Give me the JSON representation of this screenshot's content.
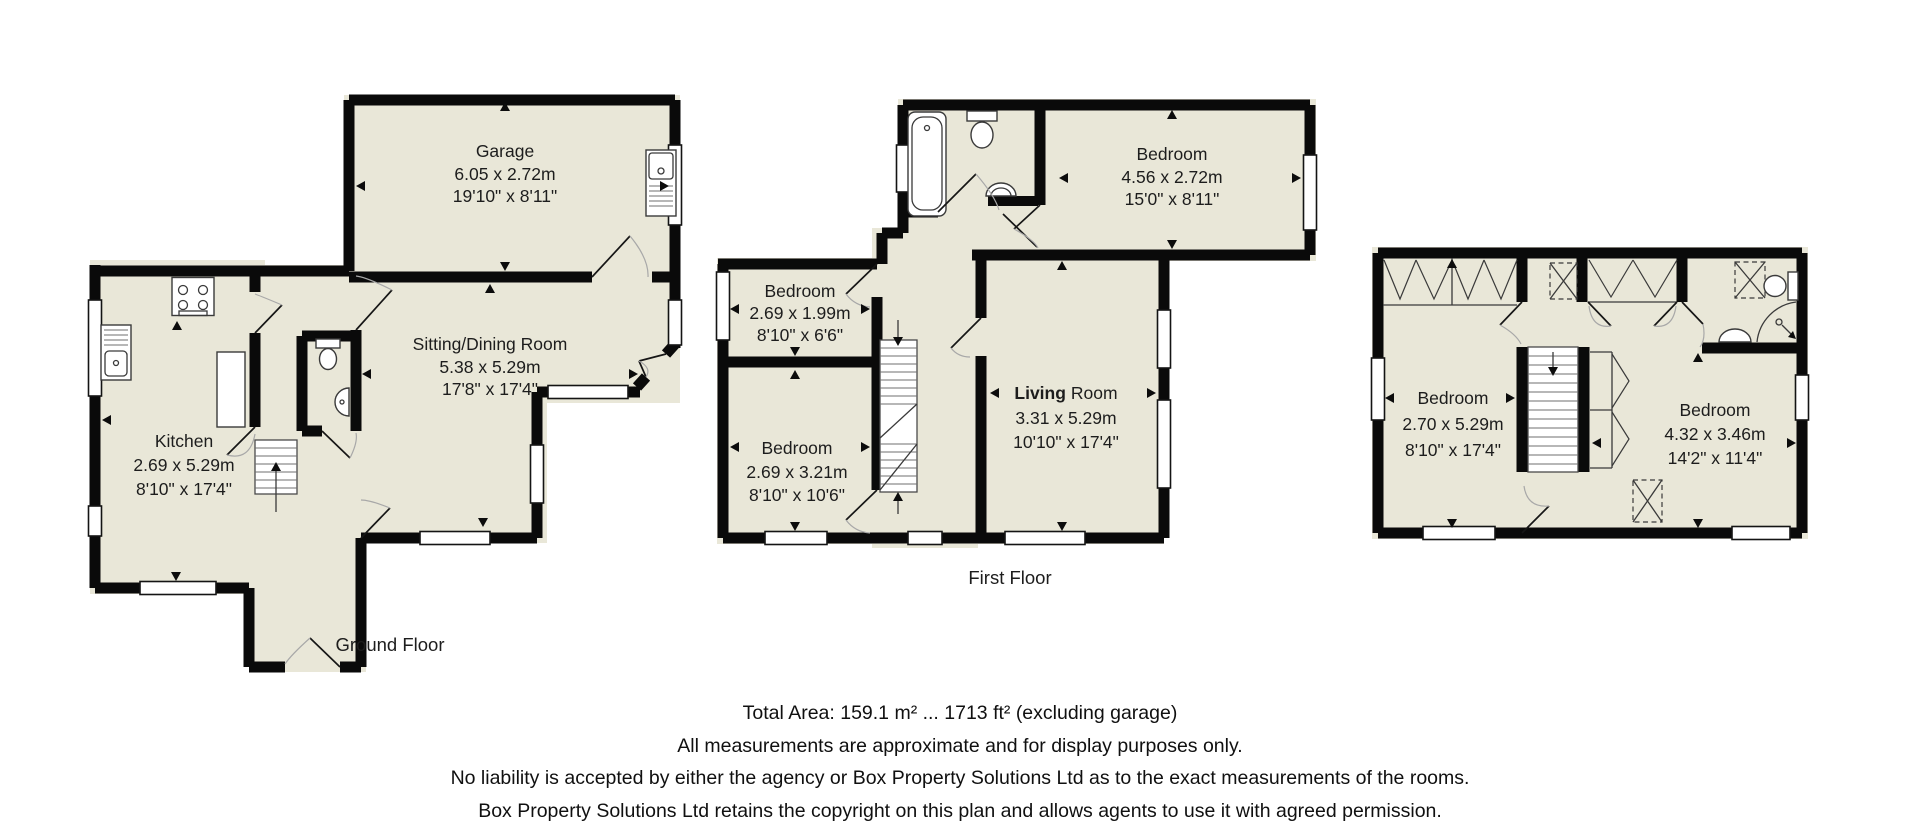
{
  "colors": {
    "room_fill": "#e9e7d8",
    "wall": "#0a0a0a"
  },
  "ground_floor": {
    "label": "Ground Floor",
    "garage": {
      "name": "Garage",
      "metric": "6.05 x 2.72m",
      "imperial": "19'10\" x 8'11\""
    },
    "sitting_dining": {
      "name": "Sitting/Dining Room",
      "metric": "5.38 x 5.29m",
      "imperial": "17'8\" x 17'4\""
    },
    "kitchen": {
      "name": "Kitchen",
      "metric": "2.69 x 5.29m",
      "imperial": "8'10\" x 17'4\""
    }
  },
  "first_floor": {
    "label": "First Floor",
    "bedroom_top": {
      "name": "Bedroom",
      "metric": "4.56 x 2.72m",
      "imperial": "15'0\" x 8'11\""
    },
    "bedroom_small": {
      "name": "Bedroom",
      "metric": "2.69 x 1.99m",
      "imperial": "8'10\" x 6'6\""
    },
    "bedroom_mid": {
      "name": "Bedroom",
      "metric": "2.69 x 3.21m",
      "imperial": "8'10\" x 10'6\""
    },
    "living_room": {
      "name_bold": "Living",
      "name_rest": "Room",
      "metric": "3.31 x 5.29m",
      "imperial": "10'10\" x 17'4\""
    }
  },
  "second_floor": {
    "bedroom_left": {
      "name": "Bedroom",
      "metric": "2.70 x 5.29m",
      "imperial": "8'10\" x 17'4\""
    },
    "bedroom_right": {
      "name": "Bedroom",
      "metric": "4.32 x 3.46m",
      "imperial": "14'2\" x 11'4\""
    }
  },
  "footer": {
    "line1": "Total Area: 159.1 m² ... 1713 ft² (excluding garage)",
    "line2": "All measurements are approximate and for display purposes only.",
    "line3": "No liability is accepted by either the agency or Box Property Solutions Ltd as to the exact measurements of the rooms.",
    "line4": "Box Property Solutions Ltd retains the copyright on this plan and allows agents to use it with agreed permission."
  }
}
